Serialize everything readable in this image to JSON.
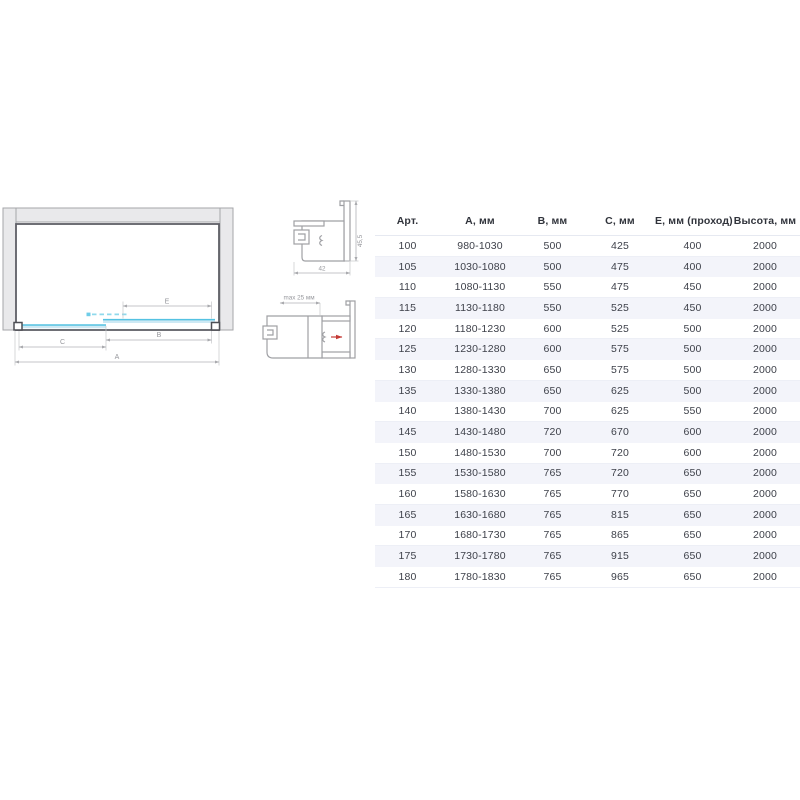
{
  "diagram": {
    "labels": {
      "A": "A",
      "B": "B",
      "C": "C",
      "E": "E"
    }
  },
  "profile_top": {
    "width_label": "42",
    "height_label": "45,5"
  },
  "profile_bottom": {
    "max_label": "max 25 мм"
  },
  "colors": {
    "glass_edge": "#55c2e2",
    "glass_fill": "#cde9f4",
    "glass_dash": "#8fd9ec",
    "wall_fill": "#e9e9eb",
    "frame_stroke": "#5e5f66",
    "dimension": "#b0b1b6",
    "stripe_row": "#f3f4fa",
    "arrow_red": "#c43a35",
    "text": "#3e414a"
  },
  "table": {
    "headers": [
      "Арт.",
      "А, мм",
      "В, мм",
      "С, мм",
      "Е, мм (проход)",
      "Высота, мм"
    ],
    "rows": [
      [
        "100",
        "980-1030",
        "500",
        "425",
        "400",
        "2000"
      ],
      [
        "105",
        "1030-1080",
        "500",
        "475",
        "400",
        "2000"
      ],
      [
        "110",
        "1080-1130",
        "550",
        "475",
        "450",
        "2000"
      ],
      [
        "115",
        "1130-1180",
        "550",
        "525",
        "450",
        "2000"
      ],
      [
        "120",
        "1180-1230",
        "600",
        "525",
        "500",
        "2000"
      ],
      [
        "125",
        "1230-1280",
        "600",
        "575",
        "500",
        "2000"
      ],
      [
        "130",
        "1280-1330",
        "650",
        "575",
        "500",
        "2000"
      ],
      [
        "135",
        "1330-1380",
        "650",
        "625",
        "500",
        "2000"
      ],
      [
        "140",
        "1380-1430",
        "700",
        "625",
        "550",
        "2000"
      ],
      [
        "145",
        "1430-1480",
        "720",
        "670",
        "600",
        "2000"
      ],
      [
        "150",
        "1480-1530",
        "700",
        "720",
        "600",
        "2000"
      ],
      [
        "155",
        "1530-1580",
        "765",
        "720",
        "650",
        "2000"
      ],
      [
        "160",
        "1580-1630",
        "765",
        "770",
        "650",
        "2000"
      ],
      [
        "165",
        "1630-1680",
        "765",
        "815",
        "650",
        "2000"
      ],
      [
        "170",
        "1680-1730",
        "765",
        "865",
        "650",
        "2000"
      ],
      [
        "175",
        "1730-1780",
        "765",
        "915",
        "650",
        "2000"
      ],
      [
        "180",
        "1780-1830",
        "765",
        "965",
        "650",
        "2000"
      ]
    ]
  }
}
